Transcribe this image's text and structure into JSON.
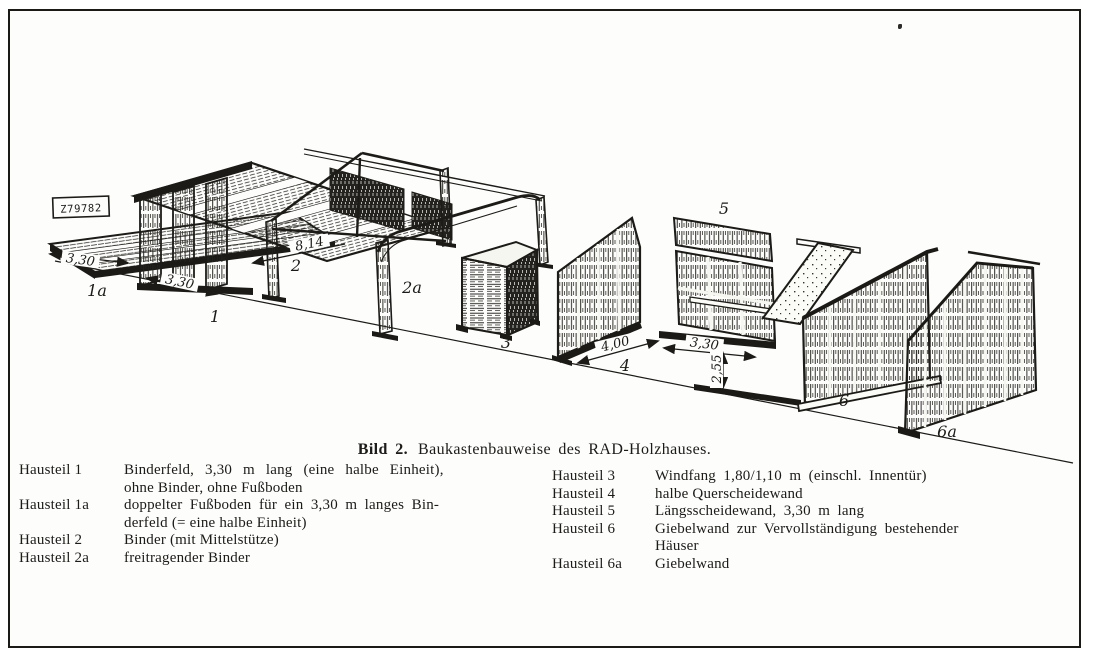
{
  "figure": {
    "stamp": "Z79782",
    "caption": {
      "prefix": "Bild 2.",
      "text": "Baukastenbauweise des RAD-Holzhauses."
    },
    "labels": {
      "part_1a": "1a",
      "part_1": "1",
      "part_2": "2",
      "part_2a": "2a",
      "part_3": "3",
      "part_4": "4",
      "part_5": "5",
      "part_6": "6",
      "part_6a": "6a"
    },
    "dimensions": {
      "floor_length": "3,30",
      "binderfeld_length": "3,30",
      "binder_span": "8,14",
      "querwand_length": "4,00",
      "laengswand_length": "3,30",
      "laengswand_height": "2,55"
    },
    "ink_color": "#1c1b18",
    "paper_color": "#fdfdfb"
  },
  "legend": {
    "left": [
      {
        "term": "Hausteil 1",
        "lines": [
          "Binderfeld, 3,30 m lang (eine halbe Einheit),",
          "ohne Binder, ohne Fußboden"
        ]
      },
      {
        "term": "Hausteil 1a",
        "lines": [
          "doppelter Fußboden für ein 3,30 m langes Bin-",
          "derfeld (= eine halbe Einheit)"
        ]
      },
      {
        "term": "Hausteil 2",
        "lines": [
          "Binder (mit Mittelstütze)"
        ]
      },
      {
        "term": "Hausteil 2a",
        "lines": [
          "freitragender Binder"
        ]
      }
    ],
    "right": [
      {
        "term": "Hausteil 3",
        "lines": [
          "Windfang 1,80/1,10 m (einschl. Innentür)"
        ]
      },
      {
        "term": "Hausteil 4",
        "lines": [
          "halbe Querscheidewand"
        ]
      },
      {
        "term": "Hausteil 5",
        "lines": [
          "Längsscheidewand, 3,30 m lang"
        ]
      },
      {
        "term": "Hausteil 6",
        "lines": [
          "Giebelwand zur Vervollständigung bestehender",
          "Häuser"
        ]
      },
      {
        "term": "Hausteil 6a",
        "lines": [
          "Giebelwand"
        ]
      }
    ]
  }
}
